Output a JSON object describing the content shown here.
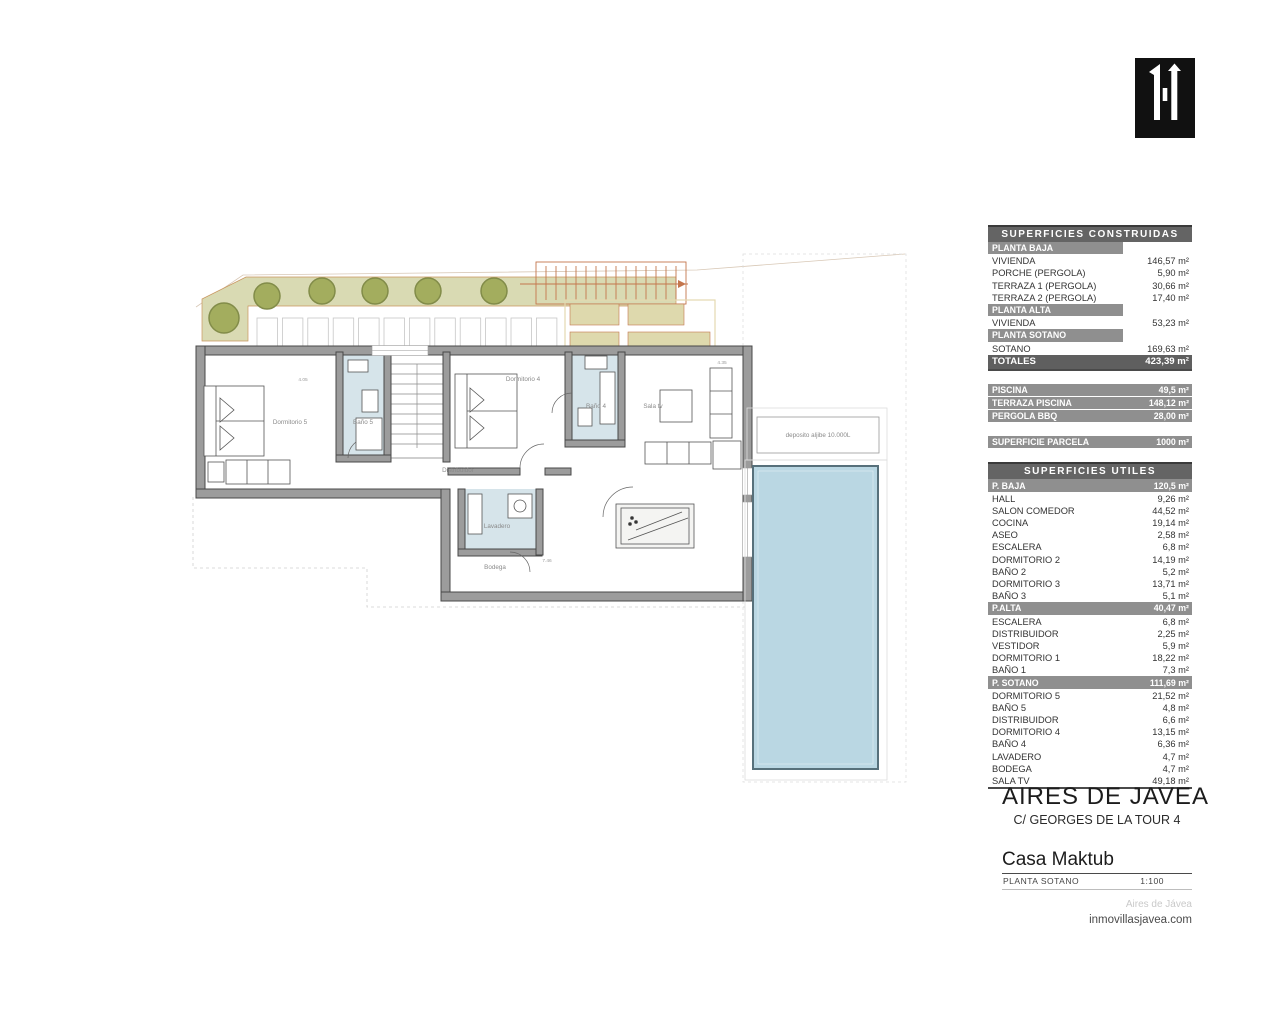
{
  "logo": {
    "name": "inmovillas-monogram-logo",
    "bg": "#111111",
    "fg": "#ffffff"
  },
  "tables": {
    "construidas": {
      "title": "SUPERFICIES CONSTRUIDAS",
      "rows": [
        {
          "type": "section-short",
          "label": "PLANTA BAJA",
          "value": ""
        },
        {
          "type": "row",
          "label": "VIVIENDA",
          "value": "146,57 m²"
        },
        {
          "type": "row",
          "label": "PORCHE (PERGOLA)",
          "value": "5,90 m²"
        },
        {
          "type": "row",
          "label": "TERRAZA 1 (PERGOLA)",
          "value": "30,66 m²"
        },
        {
          "type": "row",
          "label": "TERRAZA 2 (PERGOLA)",
          "value": "17,40 m²"
        },
        {
          "type": "section-short",
          "label": "PLANTA ALTA",
          "value": ""
        },
        {
          "type": "row",
          "label": "VIVIENDA",
          "value": "53,23 m²"
        },
        {
          "type": "section-short",
          "label": "PLANTA SOTANO",
          "value": ""
        },
        {
          "type": "row",
          "label": "SOTANO",
          "value": "169,63 m²"
        },
        {
          "type": "total",
          "label": "TOTALES",
          "value": "423,39 m²"
        }
      ]
    },
    "extras": {
      "rows": [
        {
          "type": "bar",
          "label": "PISCINA",
          "value": "49,5 m²"
        },
        {
          "type": "bar",
          "label": "TERRAZA PISCINA",
          "value": "148,12 m²"
        },
        {
          "type": "bar",
          "label": "PERGOLA BBQ",
          "value": "28,00 m²"
        }
      ]
    },
    "parcela": {
      "rows": [
        {
          "type": "bar",
          "label": "SUPERFICIE PARCELA",
          "value": "1000 m²"
        }
      ]
    },
    "utiles": {
      "title": "SUPERFICIES UTILES",
      "rows": [
        {
          "type": "section",
          "label": "P. BAJA",
          "value": "120,5 m²"
        },
        {
          "type": "row",
          "label": "HALL",
          "value": "9,26 m²"
        },
        {
          "type": "row",
          "label": "SALON COMEDOR",
          "value": "44,52 m²"
        },
        {
          "type": "row",
          "label": "COCINA",
          "value": "19,14 m²"
        },
        {
          "type": "row",
          "label": "ASEO",
          "value": "2,58 m²"
        },
        {
          "type": "row",
          "label": "ESCALERA",
          "value": "6,8 m²"
        },
        {
          "type": "row",
          "label": "DORMITORIO 2",
          "value": "14,19 m²"
        },
        {
          "type": "row",
          "label": "BAÑO 2",
          "value": "5,2 m²"
        },
        {
          "type": "row",
          "label": "DORMITORIO 3",
          "value": "13,71 m²"
        },
        {
          "type": "row",
          "label": "BAÑO 3",
          "value": "5,1 m²"
        },
        {
          "type": "section",
          "label": "P.ALTA",
          "value": "40,47 m²"
        },
        {
          "type": "row",
          "label": "ESCALERA",
          "value": "6,8 m²"
        },
        {
          "type": "row",
          "label": "DISTRIBUIDOR",
          "value": "2,25 m²"
        },
        {
          "type": "row",
          "label": "VESTIDOR",
          "value": "5,9 m²"
        },
        {
          "type": "row",
          "label": "DORMITORIO 1",
          "value": "18,22 m²"
        },
        {
          "type": "row",
          "label": "BAÑO 1",
          "value": "7,3 m²"
        },
        {
          "type": "section",
          "label": "P. SOTANO",
          "value": "111,69 m²"
        },
        {
          "type": "row",
          "label": "DORMITORIO 5",
          "value": "21,52 m²"
        },
        {
          "type": "row",
          "label": "BAÑO 5",
          "value": "4,8 m²"
        },
        {
          "type": "row",
          "label": "DISTRIBUIDOR",
          "value": "6,6 m²"
        },
        {
          "type": "row",
          "label": "DORMITORIO 4",
          "value": "13,15 m²"
        },
        {
          "type": "row",
          "label": "BAÑO 4",
          "value": "6,36 m²"
        },
        {
          "type": "row",
          "label": "LAVADERO",
          "value": "4,7 m²"
        },
        {
          "type": "row",
          "label": "BODEGA",
          "value": "4,7 m²"
        },
        {
          "type": "row",
          "label": "SALA TV",
          "value": "49,18 m²"
        }
      ]
    }
  },
  "title_block": {
    "project": "AIRES DE JAVEA",
    "address": "C/ GEORGES DE LA TOUR 4",
    "house": "Casa Maktub",
    "plan_name": "PLANTA SOTANO",
    "scale": "1:100",
    "watermark": "Aires de Jávea",
    "website": "inmovillasjavea.com"
  },
  "plan": {
    "labels": {
      "dormitorio5": "Dormitorio 5",
      "bano5": "Baño 5",
      "dormitorio4": "Dormitorio 4",
      "bano4": "Baño 4",
      "sala_tv": "Sala tv",
      "distribuidor": "Distribuidor",
      "lavadero": "Lavadero",
      "bodega": "Bodega",
      "deposito": "deposito aljibe 10.000L"
    },
    "dims": {
      "d1": "4.05",
      "d2": "4.35",
      "d3": "7.46"
    }
  },
  "colors": {
    "wall": "#9c9c9c",
    "wall_edge": "#484848",
    "pool": "#bad7e3",
    "bath_floor": "#d6e4ea",
    "garden": "#d9dab3",
    "bush": "#a3ad5e",
    "pergola_panel": "#ded9ad",
    "pergola_line": "#c4764d",
    "table_header": "#646464",
    "table_section": "#8f8f8f",
    "table_total": "#5f5f5f"
  }
}
